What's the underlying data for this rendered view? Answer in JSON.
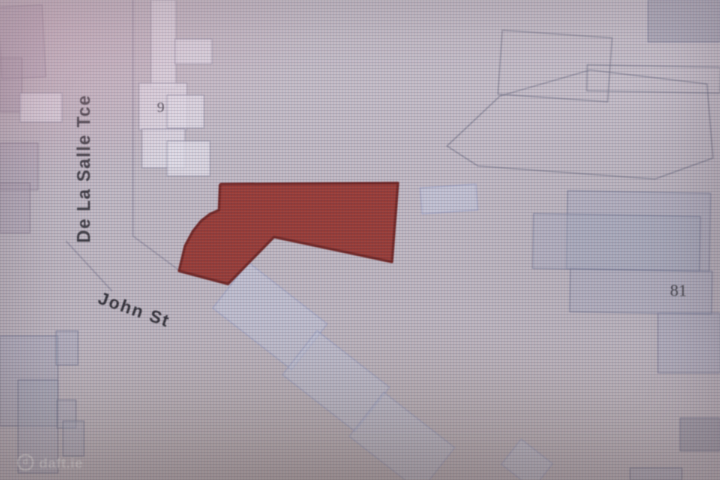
{
  "watermark": {
    "icon": "daft-logo-icon",
    "text": "daft.ie"
  },
  "map": {
    "background_color": "#c4bec7",
    "property_polygon": {
      "name": "highlighted-property",
      "points": "221,184 398,183 392,262 274,237 228,284 179,271 185,246 193,231 201,221 210,214 219,210 220,185",
      "fill": "#9e3a33",
      "stroke": "#74231f",
      "stroke_width": 2.5
    },
    "street_labels": [
      {
        "id": "de-la-salle-tce",
        "text": "De La Salle Tce",
        "x": 90,
        "y": 243,
        "rotate": -90,
        "size": 18,
        "spacing": 1.2,
        "weight": "600",
        "font": "sans",
        "color": "#3b3b41"
      },
      {
        "id": "john-st",
        "text": "John St",
        "x": 97,
        "y": 303,
        "rotate": 19,
        "size": 17.5,
        "spacing": 1.5,
        "weight": "600",
        "font": "sans",
        "color": "#2f2f35"
      }
    ],
    "building_numbers": [
      {
        "id": "no-9",
        "text": "9",
        "x": 157,
        "y": 112,
        "size": 15,
        "font": "serif",
        "color": "#4a4a52"
      },
      {
        "id": "no-81",
        "text": "81",
        "x": 670,
        "y": 296,
        "size": 17,
        "font": "serif",
        "color": "#3b3b41"
      }
    ],
    "roads": [
      {
        "id": "de-la-salle-tce-edge",
        "points": "133,0 133,236 180,271"
      },
      {
        "id": "john-st-edge",
        "points": "66,241 112,291"
      }
    ],
    "road_stroke": "rgba(128,126,150,0.55)",
    "outline_stroke": "rgba(112,114,134,0.60)",
    "palette": {
      "west": {
        "fill": "rgba(176,163,182,0.40)",
        "stroke": "rgba(132,122,142,0.55)"
      },
      "light": {
        "fill": "rgba(228,226,236,0.78)",
        "stroke": "rgba(142,142,162,0.60)"
      },
      "blue": {
        "fill": "rgba(199,207,231,0.50)",
        "stroke": "rgba(150,160,202,0.65)"
      },
      "right": {
        "fill": "rgba(173,178,199,0.45)",
        "stroke": "rgba(120,124,152,0.70)"
      },
      "dark": {
        "fill": "rgba(149,149,169,0.55)",
        "stroke": "rgba(118,122,150,0.70)"
      }
    },
    "buildings_filled": [
      {
        "x": 0,
        "y": 6,
        "w": 44,
        "h": 72,
        "rot": -3,
        "c": "west"
      },
      {
        "x": 0,
        "y": 58,
        "w": 22,
        "h": 54,
        "rot": 0,
        "c": "west"
      },
      {
        "x": 20,
        "y": 93,
        "w": 42,
        "h": 29,
        "rot": 0,
        "c": "light"
      },
      {
        "x": 0,
        "y": 143,
        "w": 38,
        "h": 47,
        "rot": 0,
        "c": "west"
      },
      {
        "x": 0,
        "y": 183,
        "w": 30,
        "h": 50,
        "rot": 0,
        "c": "west"
      },
      {
        "x": 0,
        "y": 336,
        "w": 58,
        "h": 90,
        "rot": 0,
        "c": "right"
      },
      {
        "x": 18,
        "y": 380,
        "w": 40,
        "h": 93,
        "rot": 0,
        "c": "right"
      },
      {
        "x": 56,
        "y": 331,
        "w": 22,
        "h": 34,
        "rot": 0,
        "c": "right"
      },
      {
        "x": 57,
        "y": 400,
        "w": 19,
        "h": 28,
        "rot": 0,
        "c": "right"
      },
      {
        "x": 63,
        "y": 421,
        "w": 21,
        "h": 35,
        "rot": 0,
        "c": "right"
      },
      {
        "x": 151,
        "y": 0,
        "w": 25,
        "h": 88,
        "rot": 0,
        "c": "light"
      },
      {
        "x": 175,
        "y": 39,
        "w": 37,
        "h": 25,
        "rot": 0,
        "c": "light"
      },
      {
        "x": 139,
        "y": 83,
        "w": 48,
        "h": 47,
        "rot": 0,
        "c": "light"
      },
      {
        "x": 167,
        "y": 95,
        "w": 37,
        "h": 33,
        "rot": 0,
        "c": "light"
      },
      {
        "x": 142,
        "y": 129,
        "w": 43,
        "h": 39,
        "rot": 0,
        "c": "light"
      },
      {
        "x": 167,
        "y": 141,
        "w": 43,
        "h": 35,
        "rot": 0,
        "c": "light"
      },
      {
        "x": 421,
        "y": 186,
        "w": 56,
        "h": 26,
        "rot": -4,
        "c": "blue"
      },
      {
        "x": 220,
        "y": 287,
        "w": 100,
        "h": 58,
        "rot": 38,
        "c": "blue"
      },
      {
        "x": 290,
        "y": 353,
        "w": 92,
        "h": 56,
        "rot": 38,
        "c": "blue"
      },
      {
        "x": 357,
        "y": 414,
        "w": 90,
        "h": 56,
        "rot": 38,
        "c": "blue"
      },
      {
        "x": 507,
        "y": 448,
        "w": 40,
        "h": 32,
        "rot": 38,
        "c": "blue"
      },
      {
        "x": 648,
        "y": 0,
        "w": 72,
        "h": 42,
        "rot": 0,
        "c": "dark"
      },
      {
        "x": 567,
        "y": 192,
        "w": 143,
        "h": 78,
        "rot": 1,
        "c": "right"
      },
      {
        "x": 533,
        "y": 215,
        "w": 167,
        "h": 55,
        "rot": 1,
        "c": "right"
      },
      {
        "x": 570,
        "y": 270,
        "w": 142,
        "h": 43,
        "rot": 1,
        "c": "right"
      },
      {
        "x": 658,
        "y": 313,
        "w": 62,
        "h": 60,
        "rot": 0,
        "c": "right"
      },
      {
        "x": 680,
        "y": 418,
        "w": 40,
        "h": 33,
        "rot": 0,
        "c": "dark"
      },
      {
        "x": 630,
        "y": 468,
        "w": 52,
        "h": 12,
        "rot": 0,
        "c": "right"
      }
    ],
    "buildings_outlined": [
      {
        "x": 500,
        "y": 34,
        "w": 110,
        "h": 64,
        "rot": 4
      },
      {
        "x": 587,
        "y": 66,
        "w": 133,
        "h": 26,
        "rot": 1
      }
    ],
    "outlined_polygons": [
      {
        "points": "447,146 500,96 590,70 707,84 713,158 655,179 478,166"
      }
    ]
  }
}
